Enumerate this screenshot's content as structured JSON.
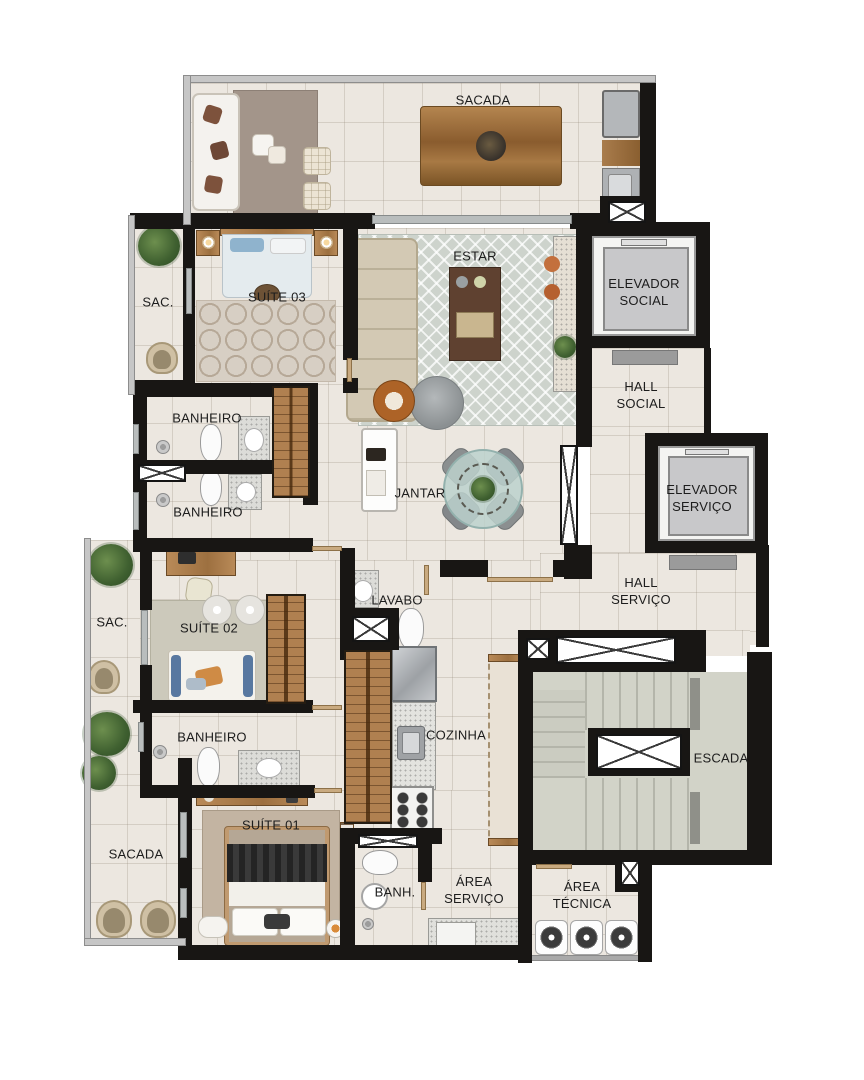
{
  "labels": {
    "sacada_top": "SACADA",
    "sac_top": "SAC.",
    "suite_03": "SUÍTE 03",
    "estar": "ESTAR",
    "elevador_social": "ELEVADOR\nSOCIAL",
    "banheiro_1": "BANHEIRO",
    "banheiro_2": "BANHEIRO",
    "jantar": "JANTAR",
    "hall_social": "HALL\nSOCIAL",
    "elevador_servico": "ELEVADOR\nSERVIÇO",
    "hall_servico": "HALL\nSERVIÇO",
    "sac_mid": "SAC.",
    "suite_02": "SUÍTE 02",
    "lavabo": "LAVABO",
    "banheiro_3": "BANHEIRO",
    "cozinha": "COZINHA",
    "escada": "ESCADA",
    "suite_01": "SUÍTE 01",
    "sacada_bottom": "SACADA",
    "banh": "BANH.",
    "area_servico": "ÁREA\nSERVIÇO",
    "area_tecnica": "ÁREA\nTÉCNICA"
  },
  "colors": {
    "wall": "#181614",
    "floor": "#ece7e0",
    "floor_grid": "#d5ccc1",
    "railing": "#c6c6c6",
    "wood": "#b08050",
    "rug_living": "#cdd3cc",
    "rug_bedroom": "#d7cfc4",
    "stairs_concrete": "#d2d3c8",
    "dining_glass": "#bcd1cd",
    "accent_orange": "#ad6327",
    "accent_blue": "#5878a0",
    "plant_green": "#3f6030",
    "label_text": "#1d1d1d"
  }
}
